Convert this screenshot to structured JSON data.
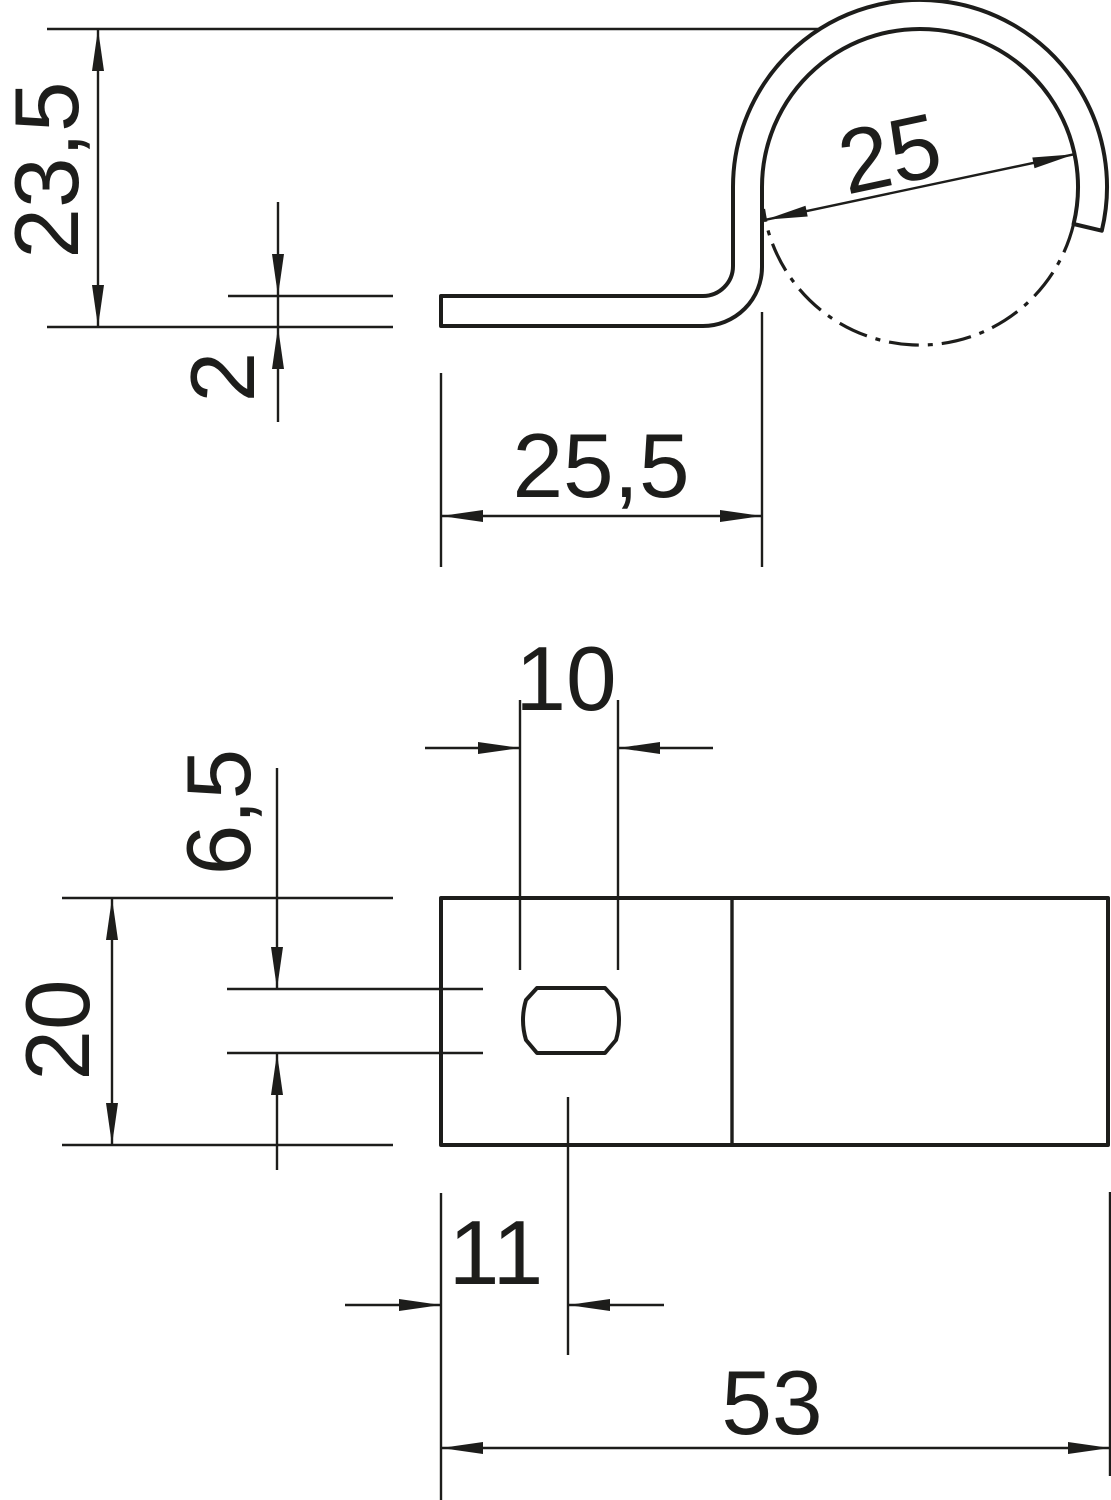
{
  "drawing": {
    "background": "#ffffff",
    "ink_color": "#1d1d1b",
    "views": {
      "side": {
        "dims": {
          "overall_height": "23,5",
          "material_thickness": "2",
          "clamping_diameter": "25",
          "leg_length": "25,5"
        }
      },
      "plan": {
        "dims": {
          "slot_length": "10",
          "slot_width": "6,5",
          "strip_width": "20",
          "slot_center_offset": "11",
          "overall_length": "53"
        }
      }
    }
  }
}
